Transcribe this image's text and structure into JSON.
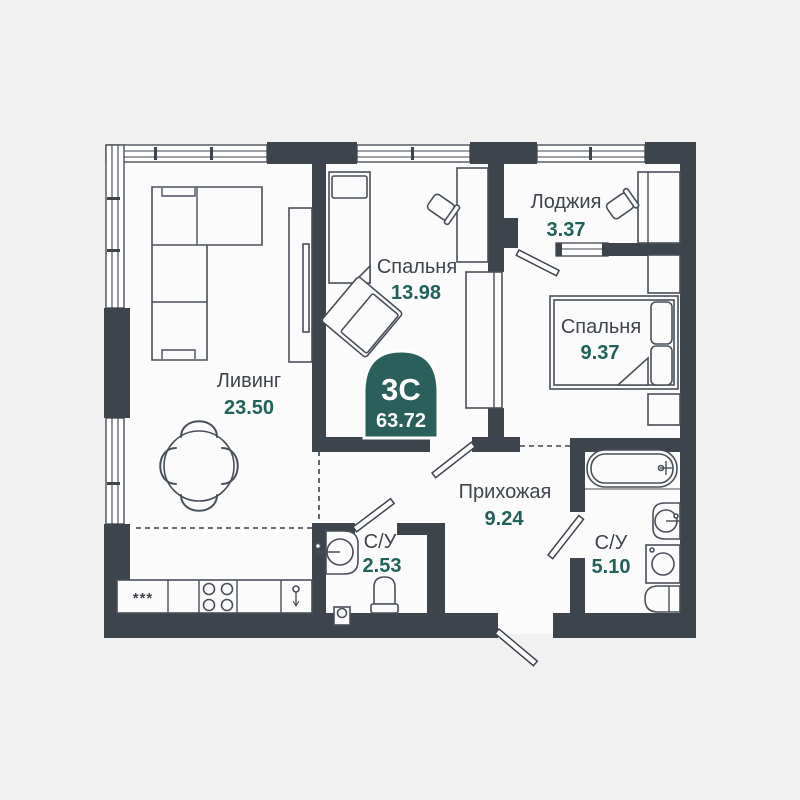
{
  "floorplan": {
    "badge": {
      "rooms_label": "3С",
      "total_area": "63.72"
    },
    "rooms": [
      {
        "key": "living",
        "name": "Ливинг",
        "area": "23.50"
      },
      {
        "key": "bedroom1",
        "name": "Спальня",
        "area": "13.98"
      },
      {
        "key": "loggia",
        "name": "Лоджия",
        "area": "3.37"
      },
      {
        "key": "bedroom2",
        "name": "Спальня",
        "area": "9.37"
      },
      {
        "key": "hallway",
        "name": "Прихожая",
        "area": "9.24"
      },
      {
        "key": "bath1",
        "name": "С/У",
        "area": "2.53"
      },
      {
        "key": "bath2",
        "name": "С/У",
        "area": "5.10"
      }
    ],
    "kitchen_marks": "***",
    "colors": {
      "background": "#f1f1f2",
      "floor": "#fbfbfb",
      "wall": "#3e444c",
      "furniture_stroke": "#4a505a",
      "accent": "#21615a",
      "badge_fill": "#2b5f5b",
      "label": "#3f454d"
    }
  }
}
